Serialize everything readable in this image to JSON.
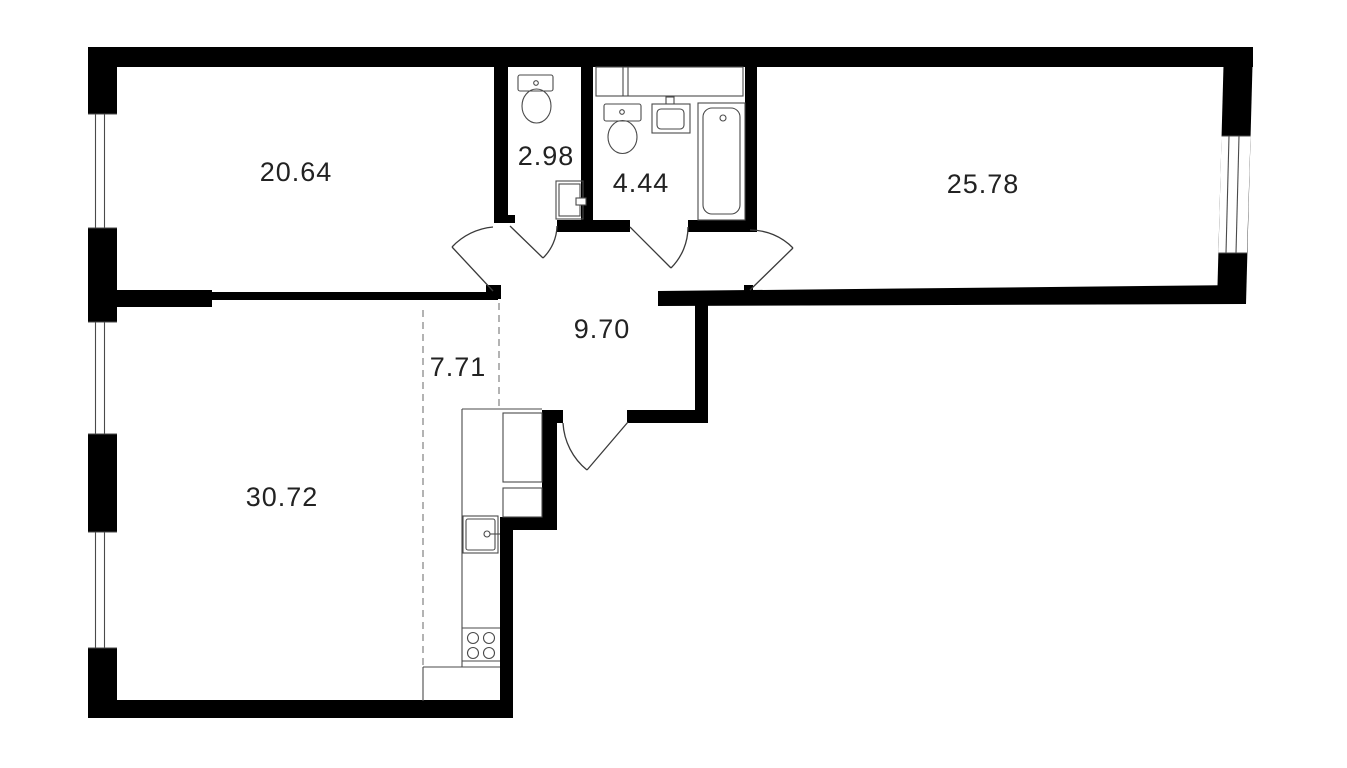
{
  "plan": {
    "title": "Apartment floor plan",
    "rooms": [
      {
        "id": "room-top-left",
        "area": "20.64"
      },
      {
        "id": "wc",
        "area": "2.98"
      },
      {
        "id": "bathroom",
        "area": "4.44"
      },
      {
        "id": "room-top-right",
        "area": "25.78"
      },
      {
        "id": "hallway",
        "area": "9.70"
      },
      {
        "id": "kitchen",
        "area": "7.71"
      },
      {
        "id": "living-room",
        "area": "30.72"
      }
    ],
    "fixtures": [
      "wc-toilet",
      "wc-cabinet",
      "bathroom-toilet",
      "bathroom-sink",
      "bathtub",
      "ventilation-shaft",
      "kitchen-cabinets",
      "kitchen-sink",
      "kitchen-stove"
    ],
    "colors": {
      "walls": "#000000",
      "fixtures": "#4a4a4a",
      "doors": "#3a3a3a",
      "dashed_zone_line": "#8a8a8a",
      "labels": "#222222",
      "background": "#ffffff"
    }
  }
}
